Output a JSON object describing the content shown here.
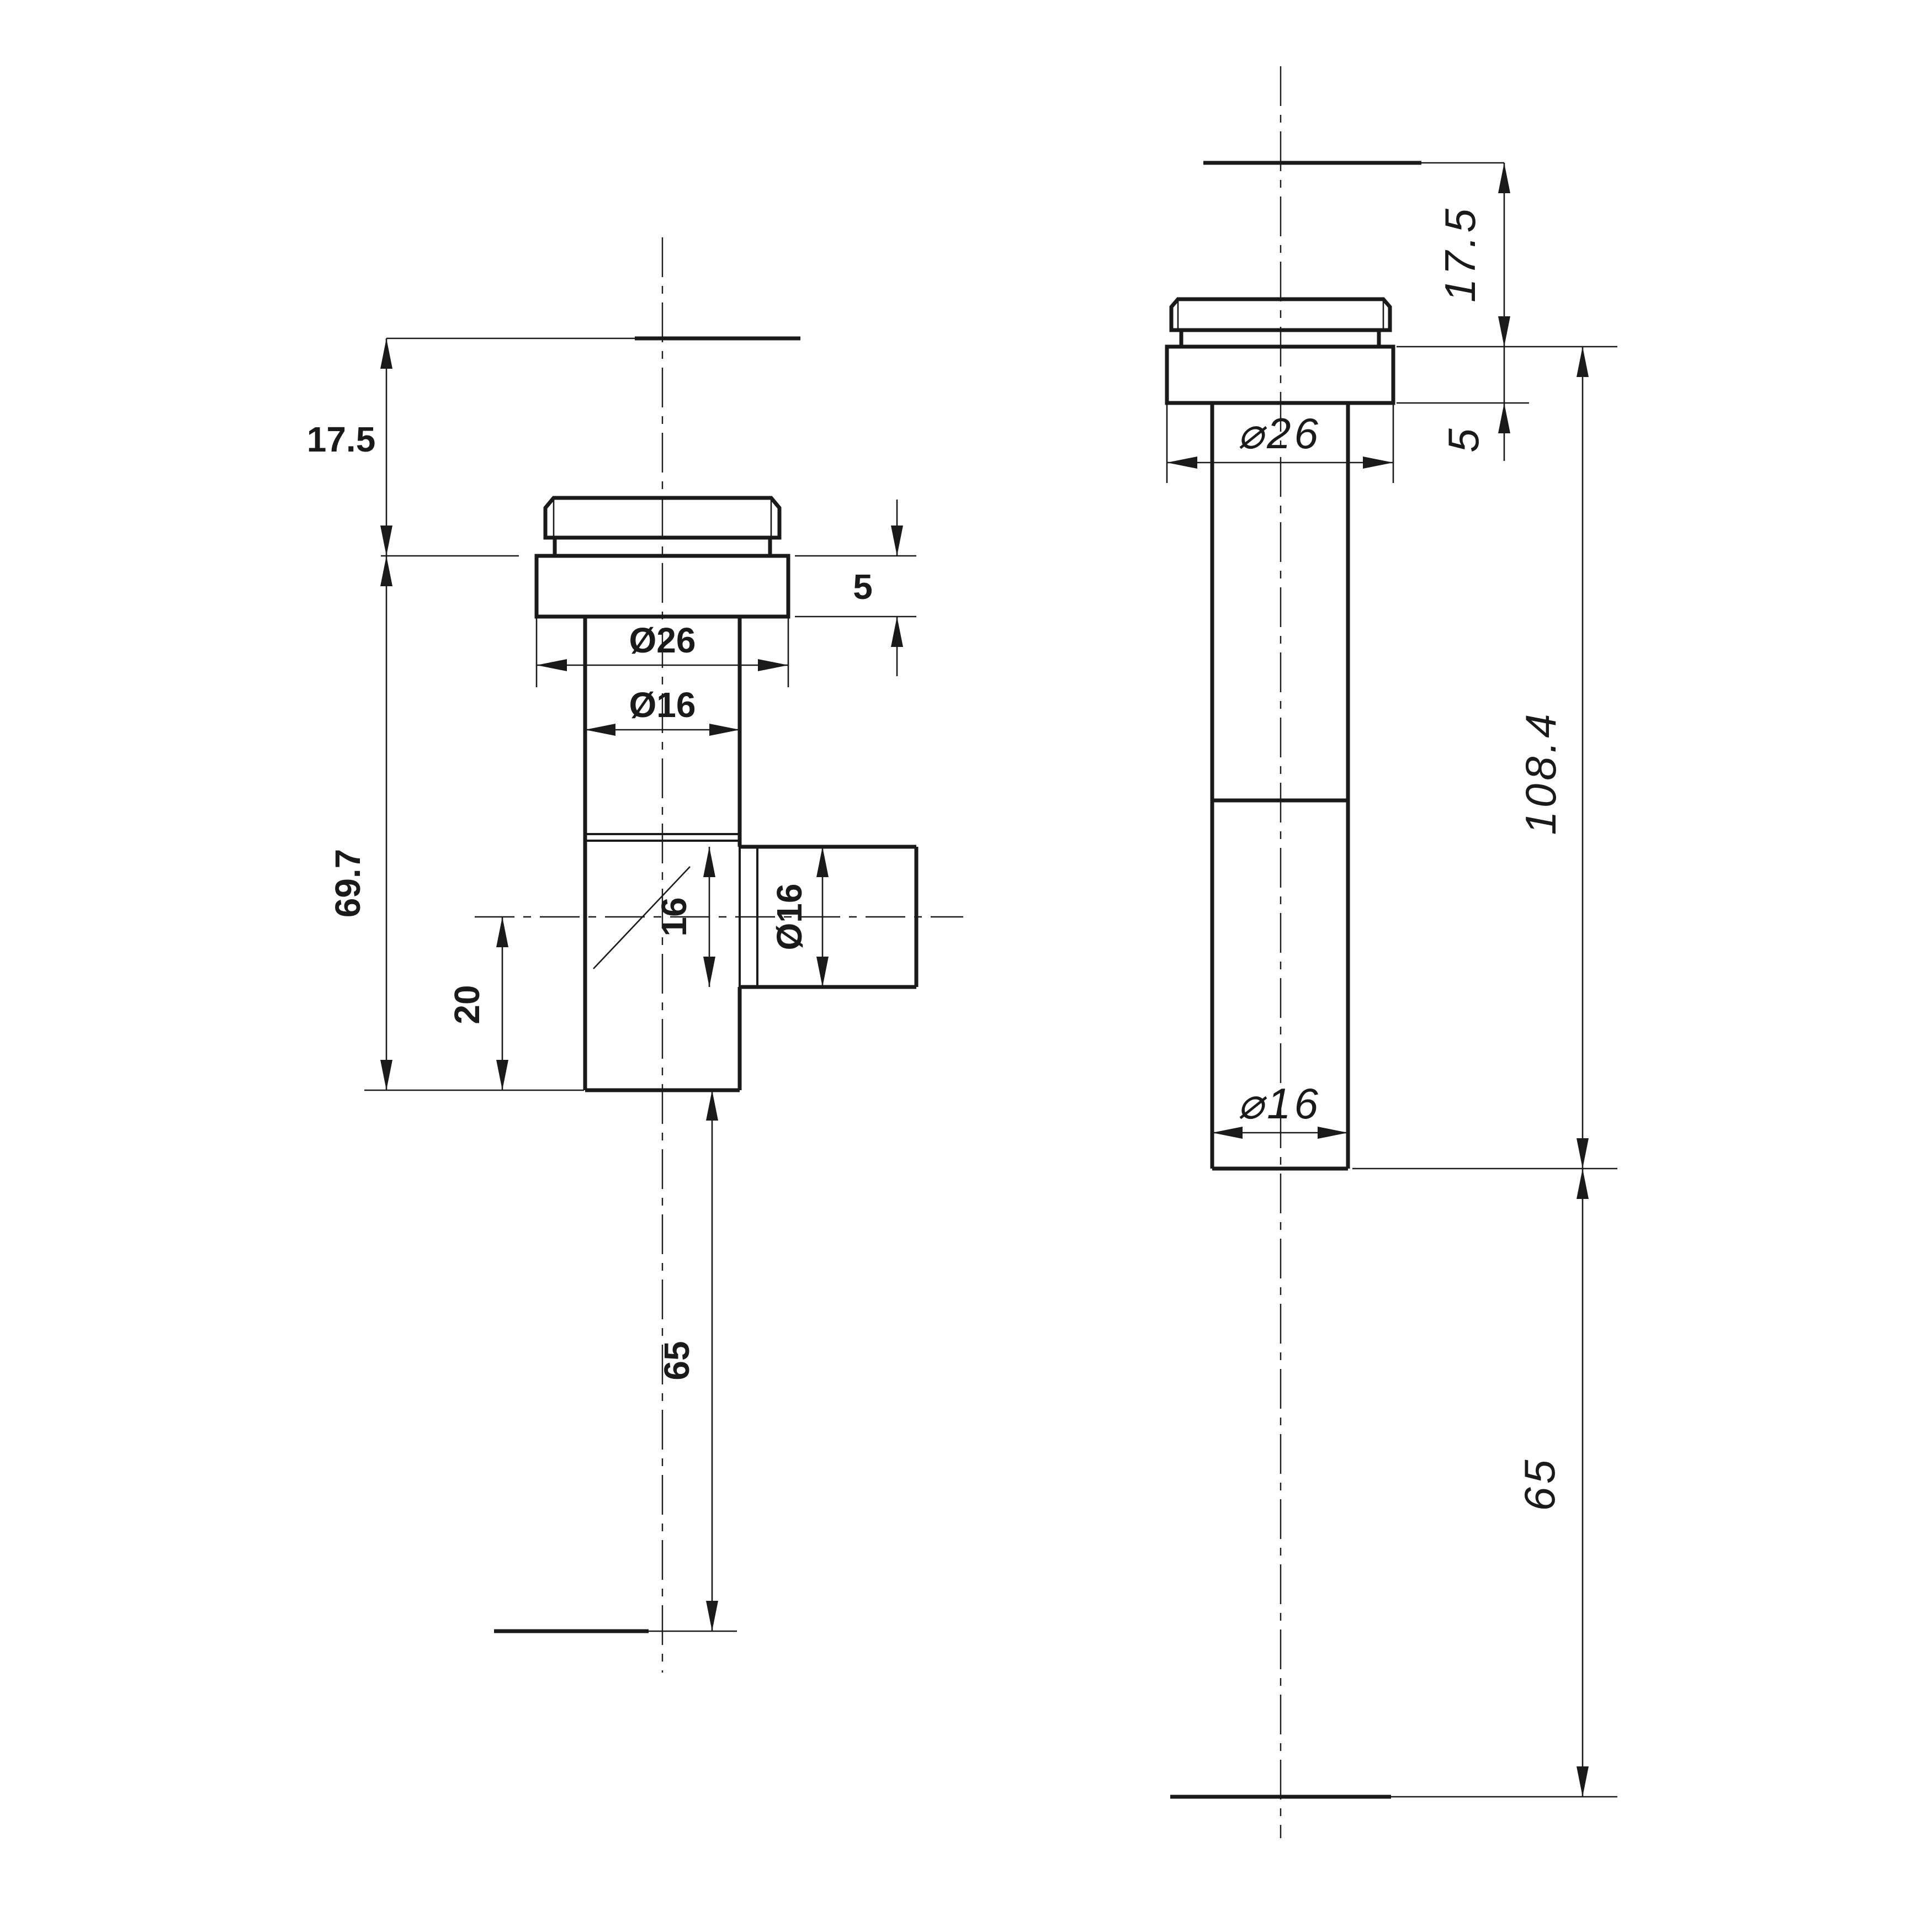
{
  "page": {
    "title": "tee-fitting-technical-drawing",
    "background": "#ffffff",
    "line_color": "#1a1a1a"
  },
  "views": {
    "front": {
      "name": "front view - tee fitting with side branch",
      "labels": {
        "h17_5": "17.5",
        "h69_7": "69.7",
        "d26": "Ø26",
        "d16_top": "Ø16",
        "t5": "5",
        "b16": "16",
        "bd16": "Ø16",
        "v20": "20",
        "v65": "65"
      }
    },
    "side": {
      "name": "side view - straight tube",
      "labels": {
        "h17_5": "17.5",
        "t5": "5",
        "d26": "⌀26",
        "h108_4": "108.4",
        "d16": "⌀16",
        "v65": "65"
      }
    }
  }
}
